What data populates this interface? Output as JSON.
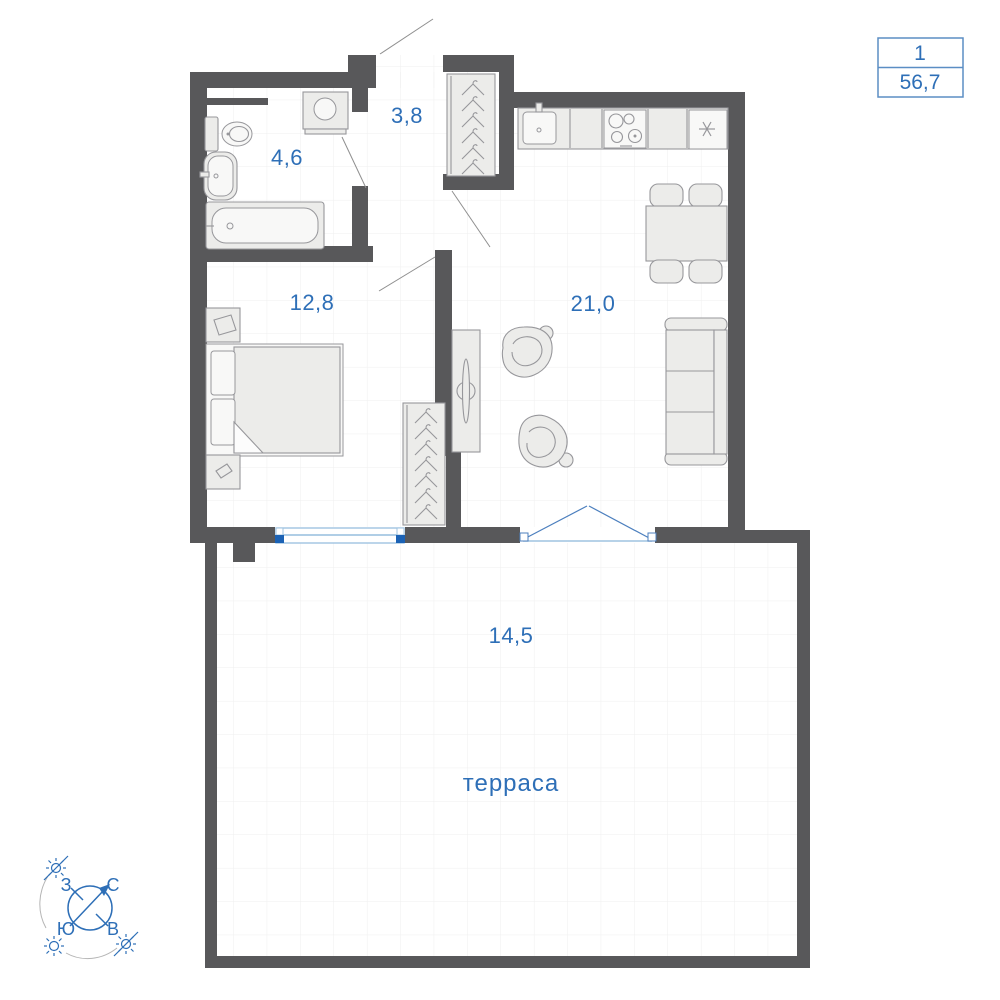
{
  "unit_badge": {
    "line1": "1",
    "line2": "56,7"
  },
  "rooms": {
    "bathroom": {
      "area": "4,6"
    },
    "hallway": {
      "area": "3,8"
    },
    "bedroom": {
      "area": "12,8"
    },
    "living_kitchen": {
      "area": "21,0"
    },
    "terrace": {
      "area": "14,5",
      "name": "терраса"
    }
  },
  "compass": {
    "north": "С",
    "south": "Ю",
    "west": "З",
    "east": "В"
  },
  "colors": {
    "wall": "#58585a",
    "label_blue": "#2e6fb7",
    "badge_border": "#5b8ec4",
    "window_blue": "#1b62b5",
    "window_light_blue": "#9fc3e0",
    "furniture_fill": "#ececea",
    "furniture_stroke": "#97979b",
    "grid": "#efefef"
  },
  "icons": {
    "hanger": "coat-hanger-outline",
    "sun": "☀",
    "sun_crossed": "☀ with strike-through",
    "snowflake": "✳",
    "compass_arrow": "↗"
  }
}
